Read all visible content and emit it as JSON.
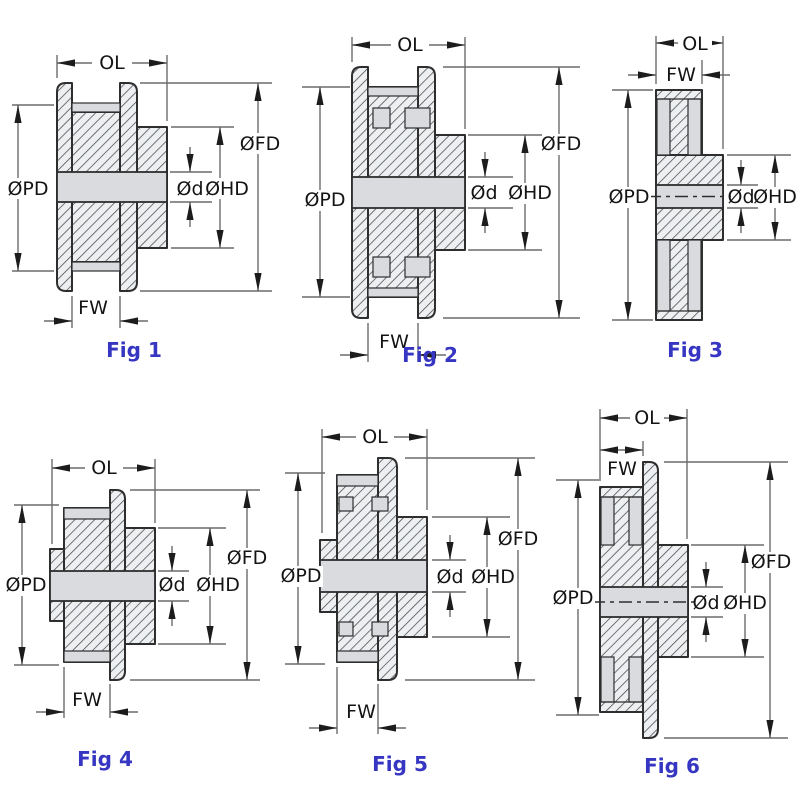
{
  "colors": {
    "page_bg": "#ffffff",
    "caption": "#3636c2",
    "label": "#141414",
    "line": "#2e2e2e",
    "dim_line": "#6b6b6b",
    "fill_light": "#d9dbde",
    "hatch_bg": "#edeff1",
    "hatch_line": "#454a4f",
    "arrow": "#1c1c1c"
  },
  "figures": [
    {
      "caption": "Fig 1",
      "labels": {
        "ol": "OL",
        "fw": "FW",
        "pd": "ØPD",
        "fd": "ØFD",
        "hd": "ØHD",
        "d": "Ød"
      }
    },
    {
      "caption": "Fig 2",
      "labels": {
        "ol": "OL",
        "fw": "FW",
        "pd": "ØPD",
        "fd": "ØFD",
        "hd": "ØHD",
        "d": "Ød"
      }
    },
    {
      "caption": "Fig 3",
      "labels": {
        "ol": "OL",
        "fw": "FW",
        "pd": "ØPD",
        "hd": "ØHD",
        "d": "Ød"
      }
    },
    {
      "caption": "Fig 4",
      "labels": {
        "ol": "OL",
        "fw": "FW",
        "pd": "ØPD",
        "fd": "ØFD",
        "hd": "ØHD",
        "d": "Ød"
      }
    },
    {
      "caption": "Fig 5",
      "labels": {
        "ol": "OL",
        "fw": "FW",
        "pd": "ØPD",
        "fd": "ØFD",
        "hd": "ØHD",
        "d": "Ød"
      }
    },
    {
      "caption": "Fig 6",
      "labels": {
        "ol": "OL",
        "fw": "FW",
        "pd": "ØPD",
        "fd": "ØFD",
        "hd": "ØHD",
        "d": "Ød"
      }
    }
  ]
}
